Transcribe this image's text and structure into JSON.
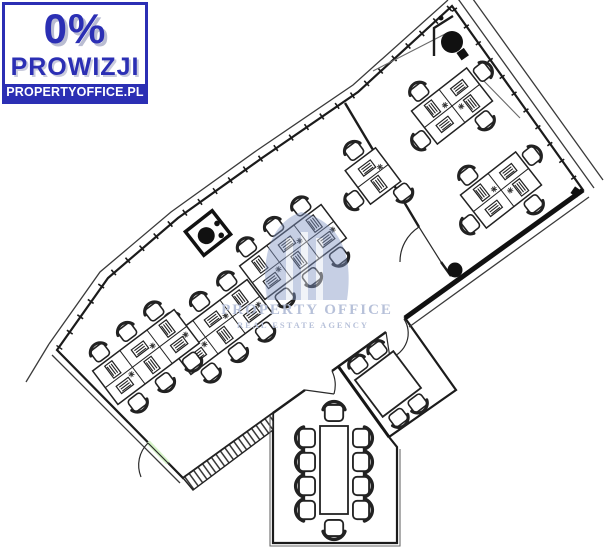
{
  "badge": {
    "percent": "0%",
    "commission_label": "PROWIZJI",
    "website": "PROPERTYOFFICE.PL"
  },
  "watermark": {
    "title": "PROPERTY OFFICE",
    "subtitle": "REAL ESTATE AGENCY"
  },
  "colors": {
    "badge_blue": "#2b2fb4",
    "floor_green": "#d6f4c8",
    "wall_dark": "#1b1b1b",
    "watermark_blue": "#8296c4",
    "watermark_text": "#b4bed8"
  }
}
